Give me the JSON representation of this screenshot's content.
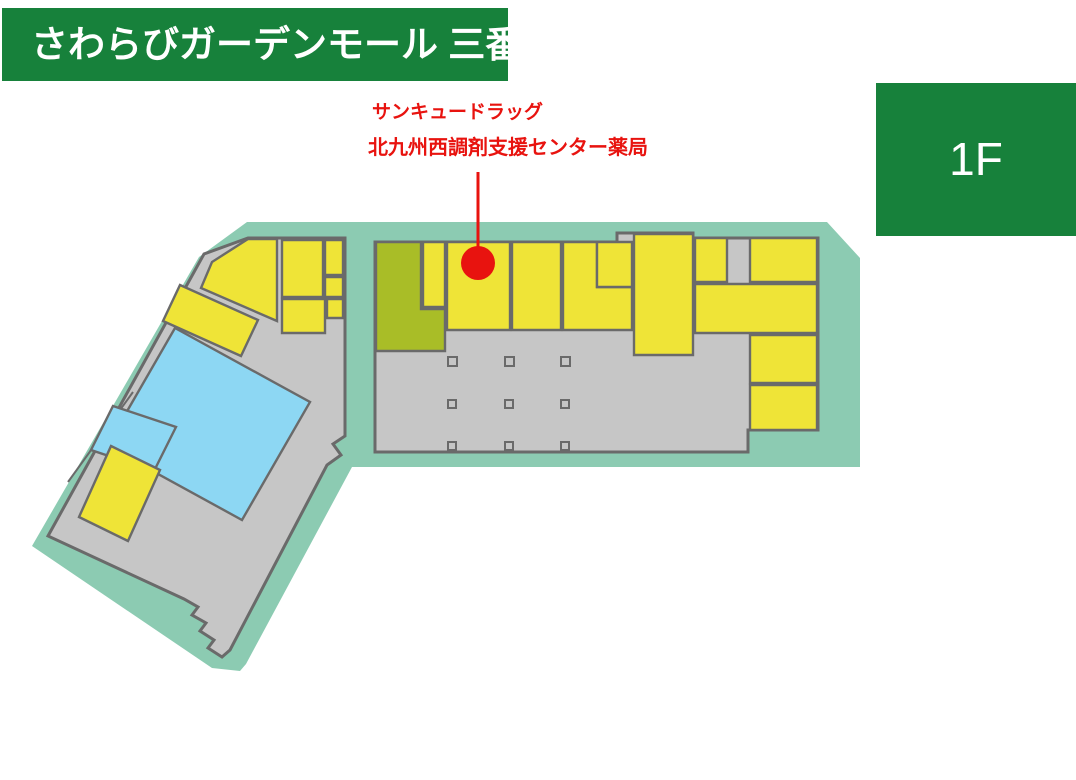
{
  "header": {
    "title": "さわらびガーデンモール 三番街"
  },
  "floor_badge": {
    "label": "1F"
  },
  "annotation": {
    "line1": "サンキュードラッグ",
    "line2": "北九州西調剤支援センター薬局"
  },
  "map": {
    "site_name": "さわらびガーデンモール 三番街",
    "floor": "1F",
    "highlighted_store": "サンキュードラッグ 北九州西調剤支援センター薬局",
    "marker": {
      "shape": "red-dot-with-leader-line"
    }
  },
  "colors": {
    "teal": "#8ccbb2",
    "floor": "#c6c6c6",
    "outline": "#6a6a6a",
    "yellow": "#efe437",
    "olive": "#a9bd27",
    "blue": "#8dd7f3",
    "red": "#e8130f",
    "green": "#17813b",
    "white": "#ffffff"
  }
}
